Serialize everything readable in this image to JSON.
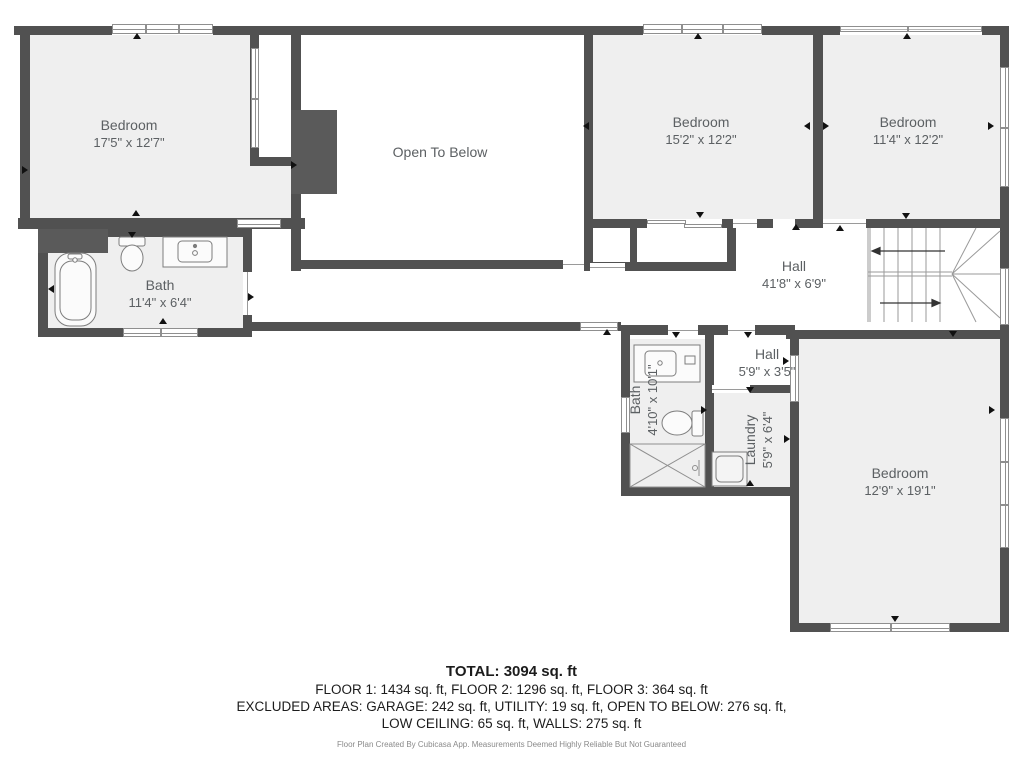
{
  "plan": {
    "rooms": [
      {
        "id": "bedroom-top-left",
        "name": "Bedroom",
        "dims": "17'5\" x 12'7\""
      },
      {
        "id": "open-to-below",
        "name": "Open To Below",
        "dims": ""
      },
      {
        "id": "bedroom-middle",
        "name": "Bedroom",
        "dims": "15'2\" x 12'2\""
      },
      {
        "id": "bedroom-top-right",
        "name": "Bedroom",
        "dims": "11'4\" x 12'2\""
      },
      {
        "id": "hall-main",
        "name": "Hall",
        "dims": "41'8\" x 6'9\""
      },
      {
        "id": "bath-main",
        "name": "Bath",
        "dims": "11'4\" x 6'4\""
      },
      {
        "id": "bath-lower",
        "name": "Bath",
        "dims": "4'10\" x 10'1\""
      },
      {
        "id": "hall-small",
        "name": "Hall",
        "dims": "5'9\" x 3'5\""
      },
      {
        "id": "laundry",
        "name": "Laundry",
        "dims": "5'9\" x 6'4\""
      },
      {
        "id": "bedroom-bottom-right",
        "name": "Bedroom",
        "dims": "12'9\" x 19'1\""
      }
    ]
  },
  "summary": {
    "total": "TOTAL: 3094 sq. ft",
    "floors": "FLOOR 1: 1434 sq. ft, FLOOR 2: 1296 sq. ft, FLOOR 3: 364 sq. ft",
    "excluded1": "EXCLUDED AREAS: GARAGE: 242 sq. ft, UTILITY: 19 sq. ft, OPEN TO BELOW: 276 sq. ft,",
    "excluded2": "LOW CEILING: 65 sq. ft, WALLS: 275 sq. ft",
    "disclaimer": "Floor Plan Created By Cubicasa App. Measurements Deemed Highly Reliable But Not Guaranteed"
  },
  "colors": {
    "wall": "#515151",
    "room_fill": "#efefef",
    "label": "#5c6063"
  }
}
